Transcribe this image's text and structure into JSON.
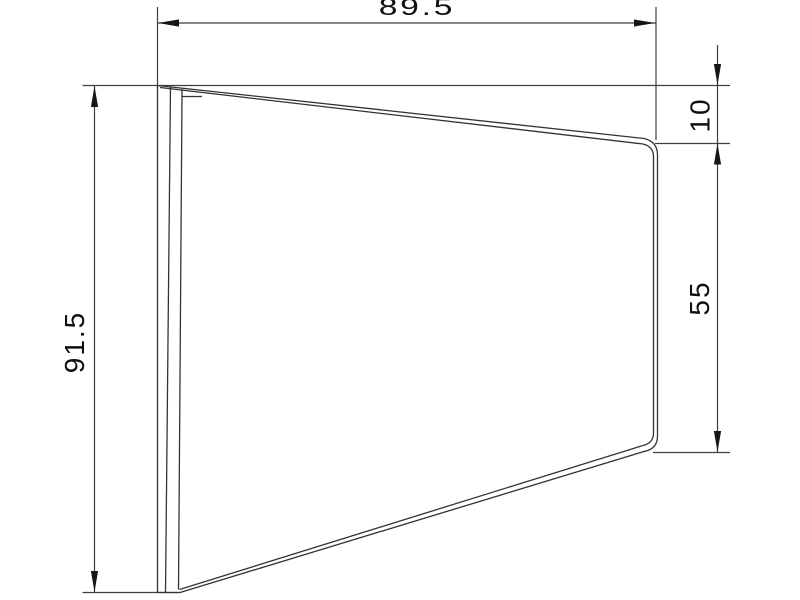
{
  "drawing": {
    "type": "technical-dimension-drawing",
    "background_color": "#ffffff",
    "line_color": "#3f3f3f",
    "shape_line_color": "#333333",
    "arrow_color": "#161616",
    "text_color": "#0f0f0f",
    "dimensions": {
      "width_top": {
        "label": "89.5",
        "value": 89.5,
        "orientation": "horizontal",
        "position": "top"
      },
      "height_left": {
        "label": "91.5",
        "value": 91.5,
        "orientation": "vertical",
        "position": "left"
      },
      "offset_top_right": {
        "label": "10",
        "value": 10,
        "orientation": "vertical",
        "position": "right"
      },
      "edge_right": {
        "label": "55",
        "value": 55,
        "orientation": "vertical",
        "position": "right"
      }
    }
  }
}
